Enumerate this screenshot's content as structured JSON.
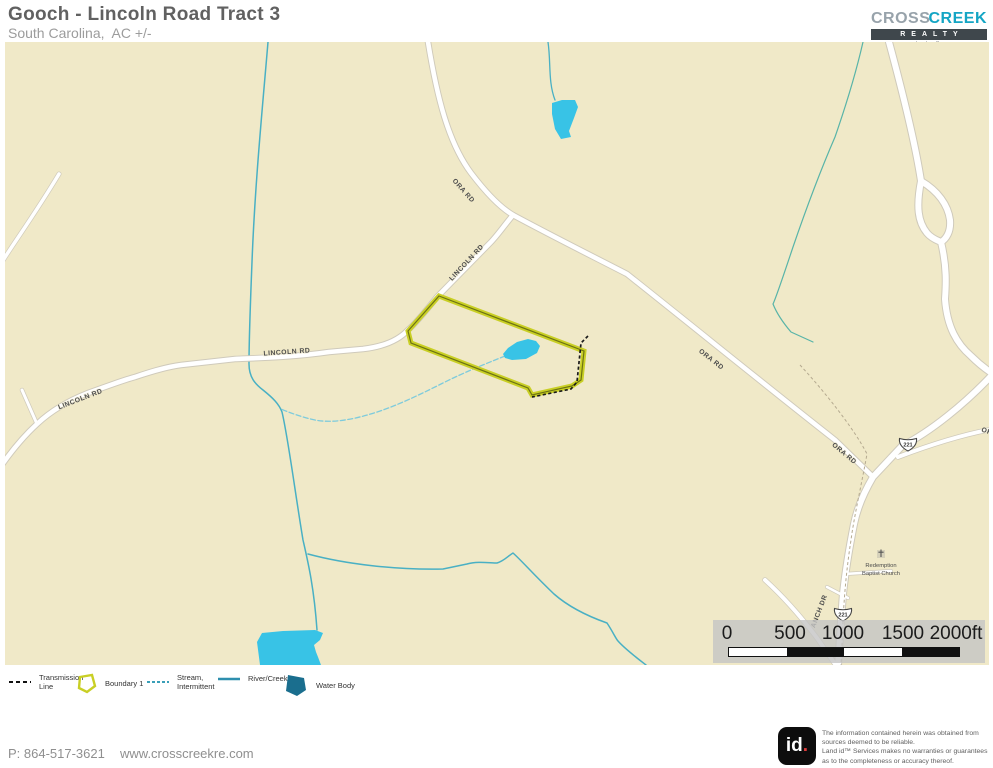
{
  "header": {
    "title": "Gooch - Lincoln Road Tract 3",
    "subtitle": "South Carolina,  AC +/-"
  },
  "logo": {
    "cross": "CROSS",
    "creek": "CREEK",
    "realty": "REALTY",
    "llc": "L L C"
  },
  "map": {
    "labels": {
      "ora_rd": "ORA RD",
      "lincoln_rd": "LINCOLN RD",
      "anch_dr": "ANCH DR",
      "route_221": "221",
      "church_line1": "Redemption",
      "church_line2": "Baptist Church"
    },
    "scale_bar": {
      "ticks": [
        "0",
        "500",
        "1000",
        "1500",
        "2000ft"
      ]
    }
  },
  "legend": {
    "items": [
      {
        "name": "transmission-line",
        "line1": "Transmission",
        "line2": "Line"
      },
      {
        "name": "boundary-1",
        "line1": "Boundary 1",
        "line2": ""
      },
      {
        "name": "stream-intermittent",
        "line1": "Stream,",
        "line2": "Intermittent"
      },
      {
        "name": "river-creek",
        "line1": "River/Creek",
        "line2": ""
      },
      {
        "name": "water-body",
        "line1": "Water Body",
        "line2": ""
      }
    ]
  },
  "footer": {
    "phone": "P: 864-517-3621",
    "website": "www.crosscreekre.com",
    "id_badge": {
      "text": "id",
      "dot": "."
    },
    "disclaimer": [
      "The information contained herein was obtained from",
      "sources deemed to be reliable.",
      "Land id™  Services makes no warranties or guarantees",
      "as to the completeness or accuracy thereof."
    ]
  },
  "colors": {
    "map_bg": "#f0e9c8",
    "water": "#38c3e6",
    "water_dark": "#1a6e8e",
    "boundary_yellow": "#c9cf25",
    "brand_teal": "#14a5c4"
  }
}
